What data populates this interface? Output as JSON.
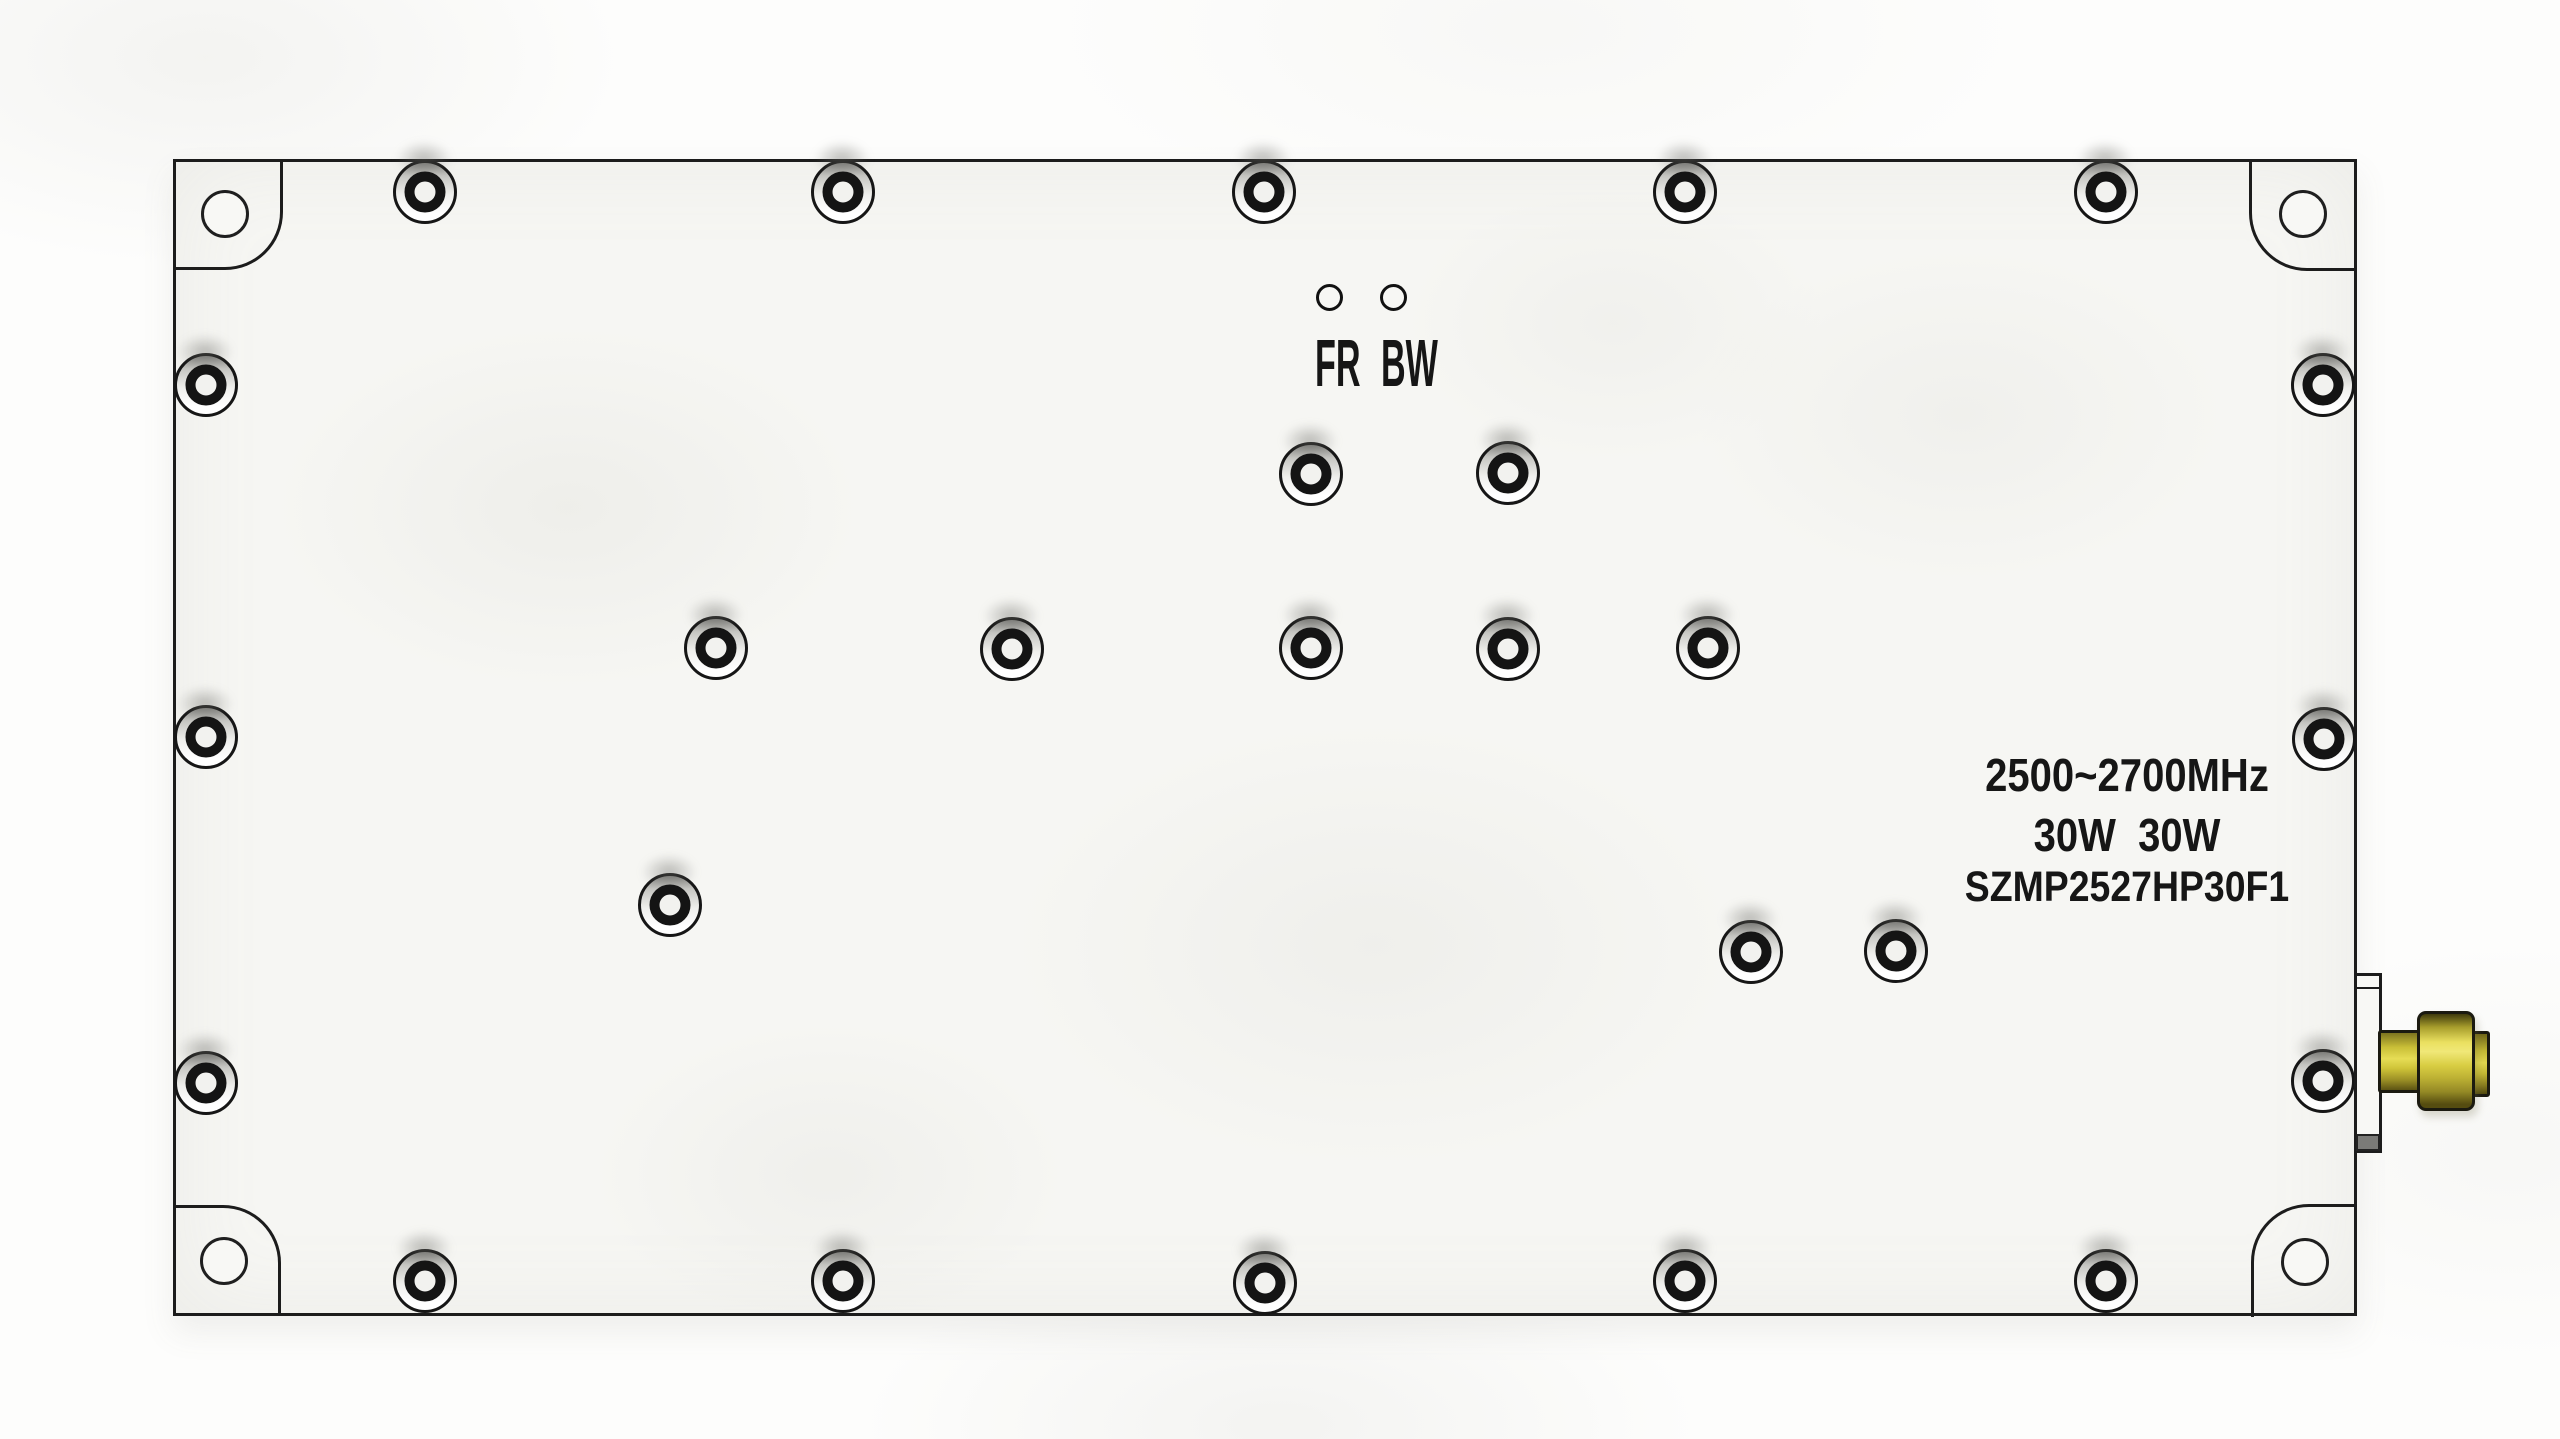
{
  "device": {
    "indicators": {
      "left": "FR",
      "right": "BW"
    },
    "labels": {
      "frequency": "2500~2700MHz",
      "power": "30W  30W",
      "model": "SZMP2527HP30F1"
    },
    "colors": {
      "panel": "#f6f6f3",
      "outline": "#1c1c1c",
      "text": "#161616",
      "screw_ring": "#141414",
      "brass_bright": "#f0e878",
      "brass_mid": "#d8cd42",
      "brass_dark": "#554c10"
    },
    "screws": [
      {
        "x": 425,
        "y": 192
      },
      {
        "x": 843,
        "y": 192
      },
      {
        "x": 1264,
        "y": 192
      },
      {
        "x": 1685,
        "y": 192
      },
      {
        "x": 2106,
        "y": 192
      },
      {
        "x": 206,
        "y": 385
      },
      {
        "x": 206,
        "y": 737
      },
      {
        "x": 206,
        "y": 1083
      },
      {
        "x": 2323,
        "y": 385
      },
      {
        "x": 2324,
        "y": 739
      },
      {
        "x": 2323,
        "y": 1081
      },
      {
        "x": 1311,
        "y": 474
      },
      {
        "x": 1508,
        "y": 473
      },
      {
        "x": 716,
        "y": 648
      },
      {
        "x": 1012,
        "y": 649
      },
      {
        "x": 1311,
        "y": 648
      },
      {
        "x": 1508,
        "y": 649
      },
      {
        "x": 1708,
        "y": 648
      },
      {
        "x": 670,
        "y": 905
      },
      {
        "x": 1751,
        "y": 952
      },
      {
        "x": 1896,
        "y": 951
      },
      {
        "x": 425,
        "y": 1281
      },
      {
        "x": 843,
        "y": 1281
      },
      {
        "x": 1265,
        "y": 1283
      },
      {
        "x": 1685,
        "y": 1281
      },
      {
        "x": 2106,
        "y": 1281
      }
    ],
    "corner_holes": [
      {
        "x": 225,
        "y": 214
      },
      {
        "x": 2303,
        "y": 214
      },
      {
        "x": 224,
        "y": 1261
      },
      {
        "x": 2305,
        "y": 1262
      }
    ],
    "led_holes": [
      {
        "x": 1329,
        "y": 297,
        "name": "led-hole-fr"
      },
      {
        "x": 1393,
        "y": 297,
        "name": "led-hole-bw"
      }
    ]
  }
}
